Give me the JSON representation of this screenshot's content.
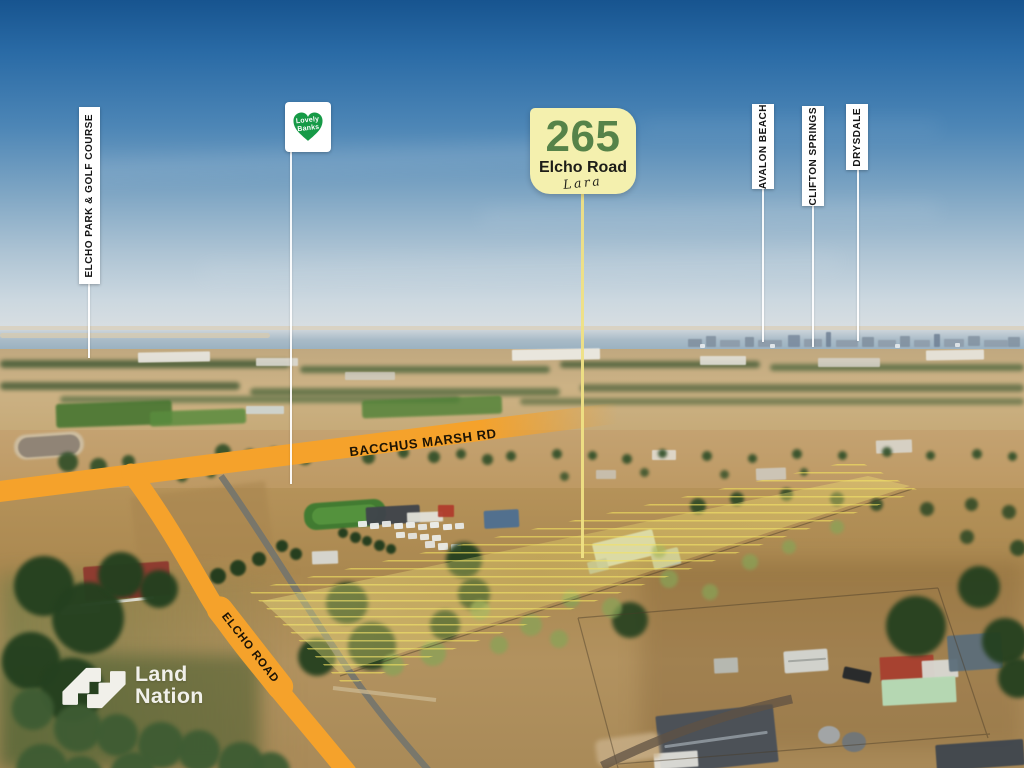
{
  "property_badge": {
    "number": "265",
    "street": "Elcho Road",
    "suburb_script": "Lara"
  },
  "estate_flag": {
    "line1": "Lovely",
    "line2": "Banks"
  },
  "location_labels": {
    "elcho_park": "ELCHO PARK & GOLF COURSE",
    "avalon_beach": "AVALON BEACH",
    "clifton_springs": "CLIFTON SPRINGS",
    "drysdale": "DRYSDALE"
  },
  "roads": {
    "bacchus": "BACCHUS MARSH RD",
    "elcho": "ELCHO ROAD"
  },
  "brand": {
    "line1": "Land",
    "line2": "Nation"
  },
  "icons": {
    "estate_heart": "heart-icon",
    "brand_mark": "landnation-monogram"
  },
  "colors": {
    "road_overlay": "#F5A22B",
    "badge_bg": "#F4F0AE",
    "badge_number": "#568349",
    "estate_green": "#169A47",
    "parcel_highlight": "#EFE06A",
    "label_bg": "#FFFFFF",
    "label_text": "#141414",
    "brand_white": "#F1F0EA"
  }
}
